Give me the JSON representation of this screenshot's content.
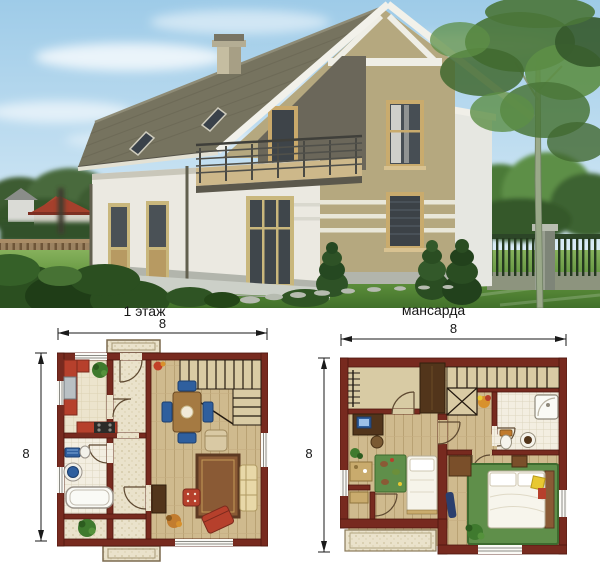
{
  "photo": {
    "palette": {
      "sky_top": "#9ecbe8",
      "sky_bottom": "#eaf4fa",
      "roof": "#76735f",
      "trim_white": "#f2f1ea",
      "gable_wall": "#b5a87f",
      "white_wall": "#ebe9e1",
      "stripe": "#e9e7d9",
      "window_glass": "#454c52",
      "window_frame": "#c9ab6d",
      "lawn": "#649740",
      "foliage": "#4a7538",
      "foliage_dark": "#2b4f20",
      "bg_roof_red": "#a5402c",
      "wood_fence": "#8d7353",
      "metal_fence": "#24381f",
      "stone_path": "#b6bbb0"
    }
  },
  "plans": {
    "palette": {
      "wall": "#772a1f",
      "wall_outline": "#4e170e",
      "floor_wood": "#cfba8e",
      "floor_tile": "#ece4cd",
      "floor_speckle": "#eae2cb",
      "bath_tile": "#f3eee1",
      "rug_green": "#5f8f4a",
      "accent_red": "#b6402c",
      "accent_blue": "#2f5f9e",
      "plant_green": "#3f7a2e",
      "furniture_wood": "#8a5a35",
      "dark_wood": "#52351b"
    },
    "floor1": {
      "title": "1 этаж",
      "width_label": "8",
      "height_label": "8"
    },
    "attic": {
      "title": "мансарда",
      "width_label": "8",
      "height_label": "8"
    }
  }
}
